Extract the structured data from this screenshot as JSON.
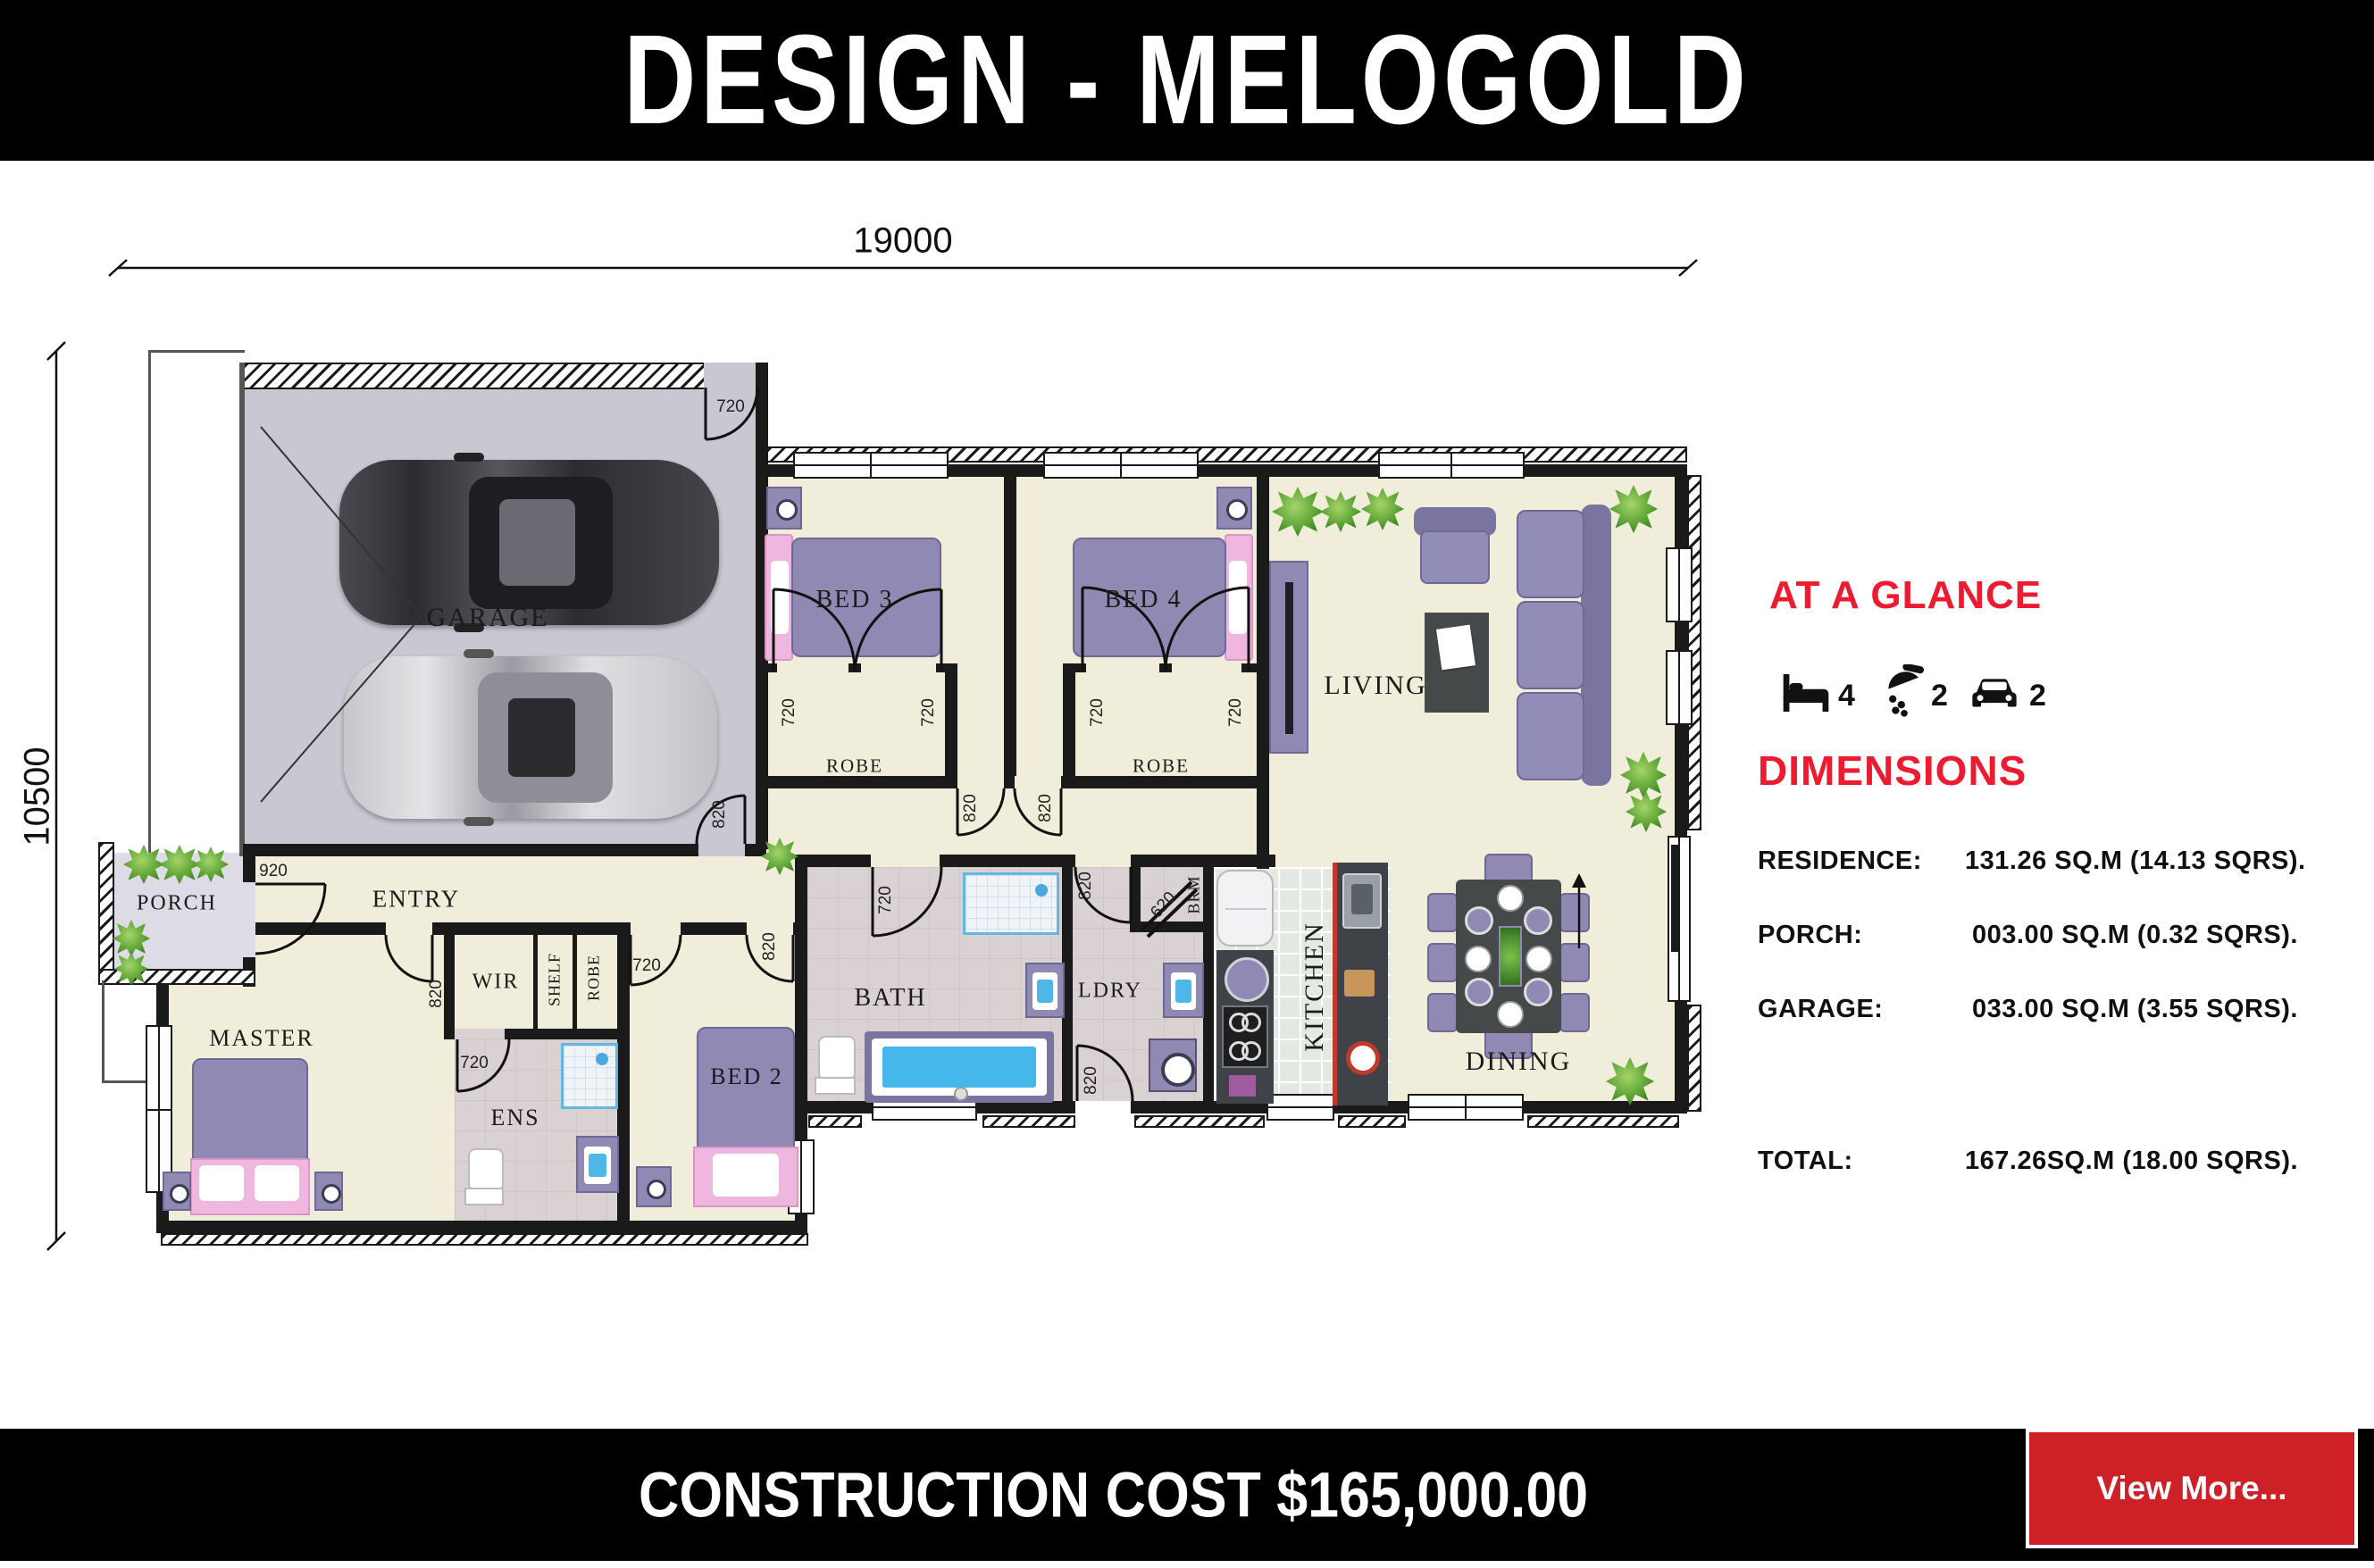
{
  "title": "DESIGN - MELOGOLD",
  "footer": {
    "cost": "CONSTRUCTION COST $165,000.00",
    "view_more": "View More..."
  },
  "glance": {
    "heading": "AT A GLANCE",
    "beds": "4",
    "showers": "2",
    "cars": "2"
  },
  "dims_panel": {
    "heading": "DIMENSIONS",
    "rows": [
      {
        "label": "RESIDENCE:",
        "value": "131.26 SQ.M (14.13 SQRS)."
      },
      {
        "label": "PORCH:",
        "value": "003.00 SQ.M (0.32 SQRS)."
      },
      {
        "label": "GARAGE:",
        "value": "033.00 SQ.M (3.55 SQRS)."
      },
      {
        "label": "TOTAL:",
        "value": "167.26SQ.M (18.00 SQRS)."
      }
    ]
  },
  "plan": {
    "width_label": "19000",
    "height_label": "10500",
    "rooms": {
      "garage": "GARAGE",
      "bed3": "BED 3",
      "bed4": "BED 4",
      "living": "LIVING",
      "robe": "ROBE",
      "entry": "ENTRY",
      "porch": "PORCH",
      "master": "MASTER",
      "wir": "WIR",
      "shelf": "SHELF",
      "ens": "ENS",
      "bed2": "BED 2",
      "bath": "BATH",
      "ldry": "LDRY",
      "brm": "BRM",
      "kitchen": "KITCHEN",
      "dining": "DINING"
    },
    "doors": {
      "d620": "620",
      "d720": "720",
      "d820": "820",
      "d920": "920"
    }
  },
  "colors": {
    "accent_red": "#ed1b2f",
    "button_red": "#ce2127",
    "band_black": "#000000"
  }
}
